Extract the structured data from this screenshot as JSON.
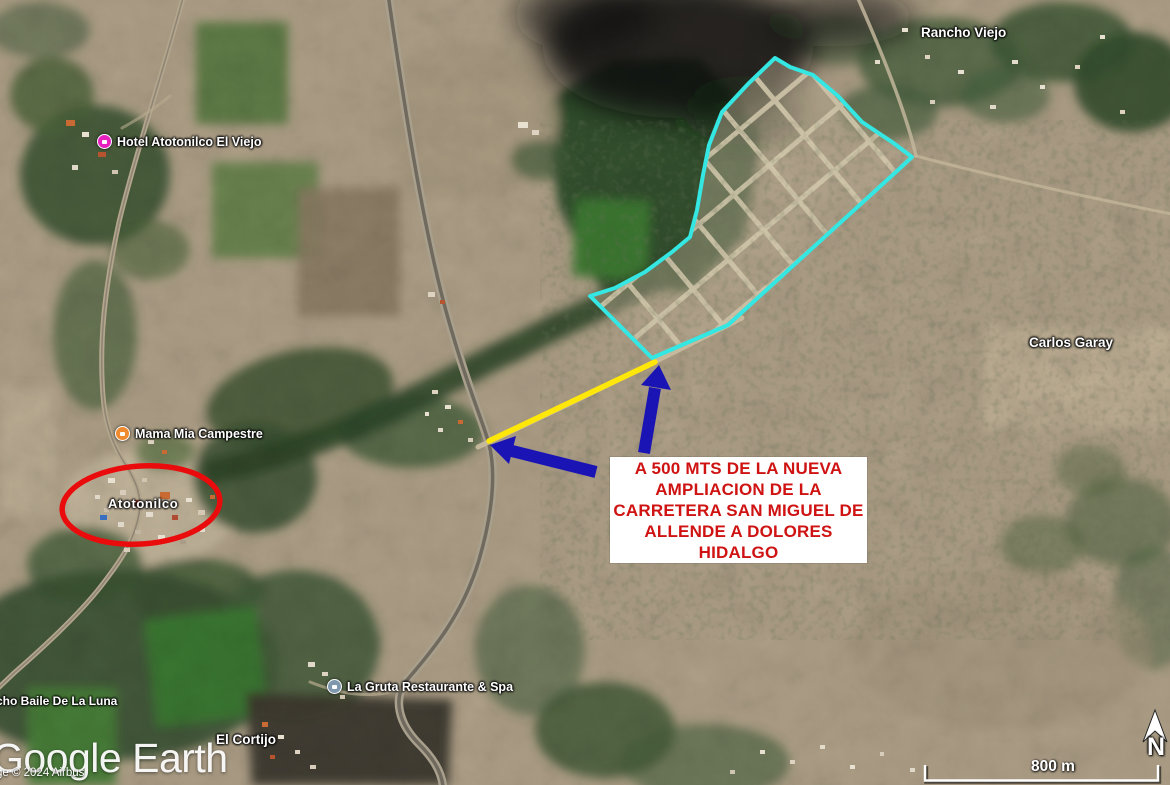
{
  "branding": {
    "logo_text": "Google Earth",
    "copyright_text": "ge © 2024 Airbus"
  },
  "scale_bar": {
    "label": "800 m"
  },
  "compass": {
    "north_label": "N"
  },
  "annotation_box": {
    "lines": [
      "A 500 MTS DE LA NUEVA",
      "AMPLIACION DE LA",
      "CARRETERA SAN MIGUEL DE",
      "ALLENDE A DOLORES",
      "HIDALGO"
    ],
    "text_color": "#cf1212",
    "background": "#ffffff"
  },
  "annotations": {
    "parcel_outline_color": "#35e7e3",
    "road_highlight_color": "#ffe70a",
    "arrow_color": "#1a14b4",
    "town_circle_color": "#ea0c0c"
  },
  "labels": {
    "rancho_viejo": {
      "text": "Rancho Viejo"
    },
    "hotel_atotonilco": {
      "text": "Hotel Atotonilco El Viejo",
      "icon": "lodging-pin",
      "icon_color": "#e620bd"
    },
    "mama_mia": {
      "text": "Mama Mia Campestre",
      "icon": "restaurant-pin",
      "icon_color": "#f08a2e"
    },
    "atotonilco": {
      "text": "Atotonilco"
    },
    "carlos_garay": {
      "text": "Carlos Garay"
    },
    "la_gruta": {
      "text": "La Gruta Restaurante & Spa",
      "icon": "place-pin",
      "icon_color": "#8098ad"
    },
    "el_cortijo": {
      "text": "El Cortijo"
    },
    "rancho_baile": {
      "text": "cho Baile De La Luna"
    }
  }
}
